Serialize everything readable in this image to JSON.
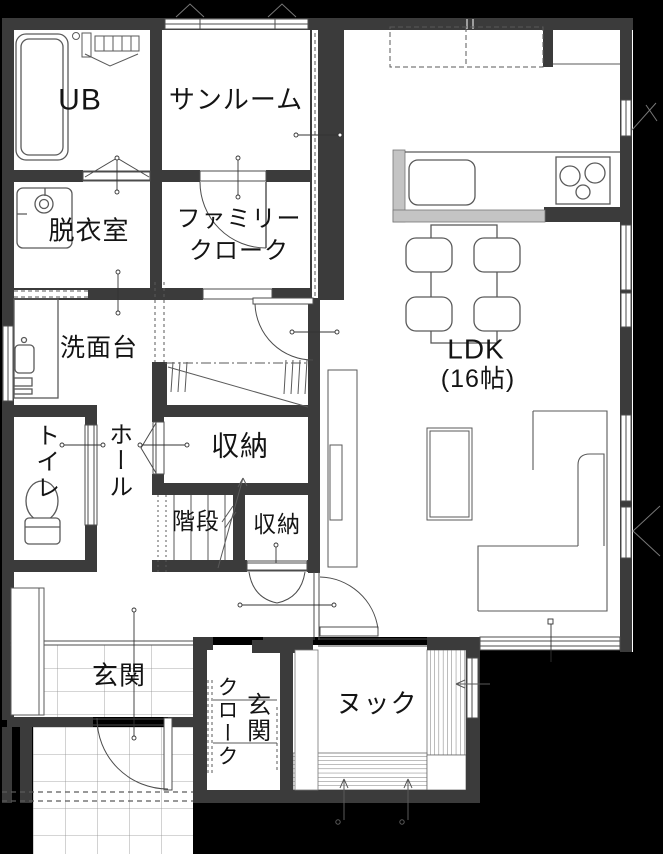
{
  "plan": {
    "type": "floor-plan",
    "colors": {
      "background": "#000000",
      "wall": "#3b3b3b",
      "floor": "#ffffff",
      "counter": "#c4c4c4",
      "line": "#4c4c4c"
    },
    "rooms": {
      "ub": {
        "label": "UB"
      },
      "sunroom": {
        "label": "サンルーム"
      },
      "datsuishitsu": {
        "label": "脱衣室"
      },
      "family_cloak": {
        "line1": "ファミリー",
        "line2": "クローク"
      },
      "senmendai": {
        "label": "洗面台"
      },
      "toilet": {
        "label": "トイレ"
      },
      "hall": {
        "label": "ホール"
      },
      "storage1": {
        "label": "収納"
      },
      "kaidan": {
        "label": "階段"
      },
      "storage2": {
        "label": "収納"
      },
      "ldk": {
        "label": "LDK",
        "size": "(16帖)"
      },
      "genkan": {
        "label": "玄関"
      },
      "genkan_cloak": {
        "col_right": "玄関",
        "col_left": "クローク"
      },
      "nook": {
        "label": "ヌック"
      }
    }
  }
}
